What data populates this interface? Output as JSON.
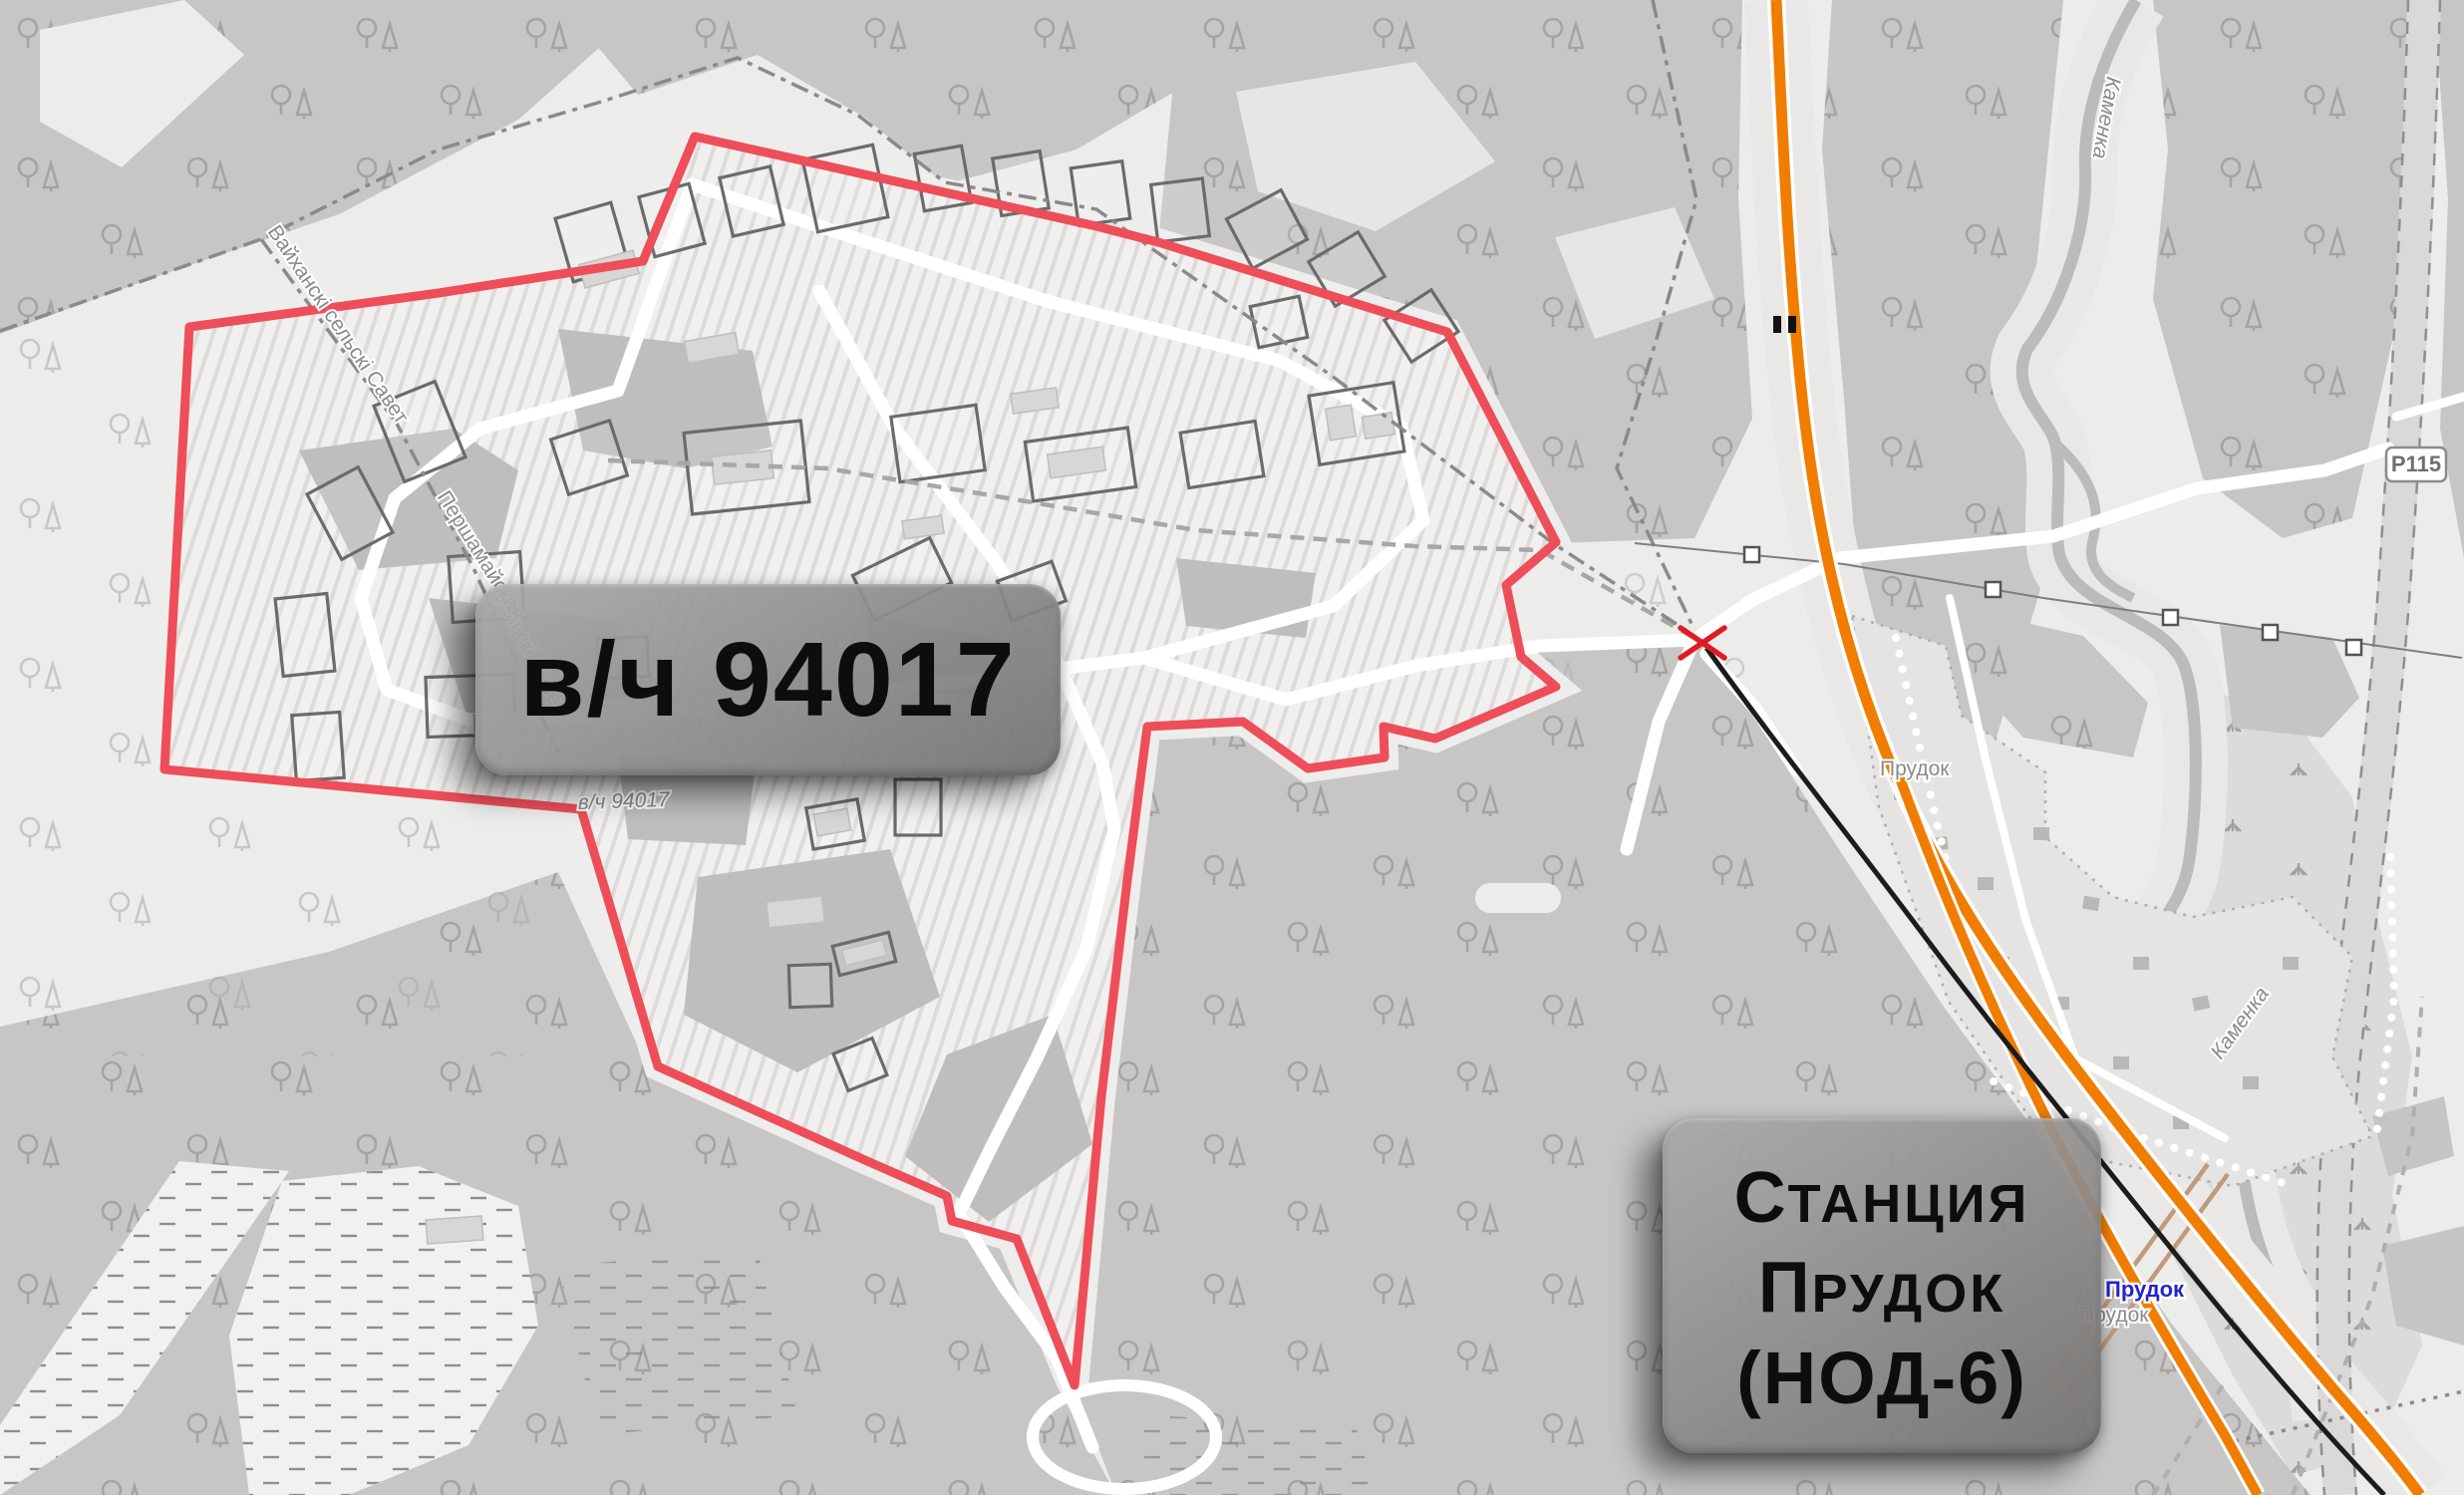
{
  "annotations": {
    "unit_label": "в/ч 94017",
    "station_label": {
      "line1_lead": "С",
      "line1_rest": "ТАНЦИЯ",
      "line2_lead": "П",
      "line2_rest": "РУДОК",
      "line3": "(НОД-6)"
    }
  },
  "map_labels": {
    "unit_small": "в/ч 94017",
    "admin_boundary": "Вайханскі сельскі Савет",
    "admin_boundary_2": "сельскі Савет",
    "street": "Першамайская",
    "river_north": "Каменка",
    "river_south": "Каменка",
    "village": "Прудок",
    "station_blue": "Прудок",
    "station_gray": "Прудок",
    "road_ref": "Р115"
  },
  "colors": {
    "red_border": "#ee4e59",
    "red_x": "#e01b24",
    "orange_road": "#f07d00",
    "railway_black": "#1c1c1c",
    "station_blue_text": "#2424cd",
    "box_text": "#0d0d0d",
    "forest_gray": "#c7c6c4",
    "background": "#ececeb",
    "compound_fill": "#f1f0ee",
    "tan_road": "#c09a7c"
  }
}
